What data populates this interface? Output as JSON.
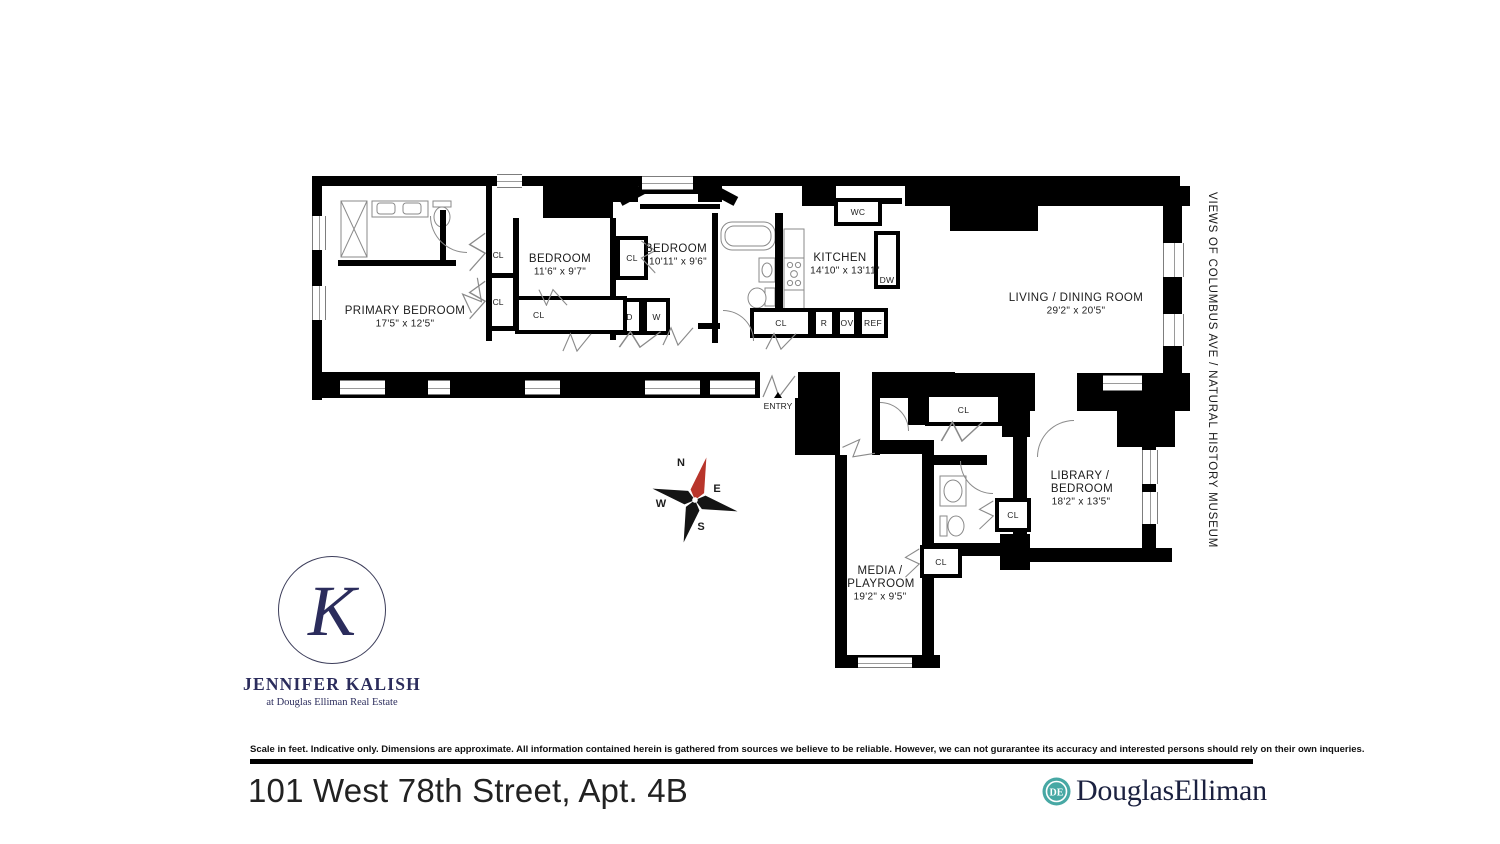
{
  "page": {
    "side_note": "VIEWS OF COLUMBUS AVE / NATURAL HISTORY MUSEUM",
    "address_title": "101 West 78th Street, Apt. 4B",
    "disclaimer": "Scale in feet. Indicative only. Dimensions are approximate. All information contained herein is gathered from sources we believe to be reliable. However, we can not gurarantee its accuracy and interested persons should rely on their own inqueries."
  },
  "agent": {
    "monogram": "K",
    "name": "JENNIFER KALISH",
    "tagline": "at Douglas Elliman Real Estate",
    "brand_color": "#2b2c5c"
  },
  "brokerage": {
    "wordmark": "DouglasElliman",
    "monogram": "DE",
    "icon_color": "#47a8a4",
    "text_color": "#1b2140"
  },
  "compass": {
    "north": "N",
    "south": "S",
    "east": "E",
    "west": "W",
    "north_color": "#b8352b",
    "arm_color": "#141414"
  },
  "floorplan": {
    "entry_label": "ENTRY",
    "rooms": {
      "primary_bedroom": {
        "name": "PRIMARY BEDROOM",
        "dims": "17'5\" x 12'5\""
      },
      "bedroom_1": {
        "name": "BEDROOM",
        "dims": "11'6\" x 9'7\""
      },
      "bedroom_2": {
        "name": "BEDROOM",
        "dims": "10'11\" x 9'6\""
      },
      "kitchen": {
        "name": "KITCHEN",
        "dims": "14'10\" x 13'11\""
      },
      "living_dining": {
        "name": "LIVING / DINING ROOM",
        "dims": "29'2\" x 20'5\""
      },
      "library_bedroom": {
        "name_line1": "LIBRARY /",
        "name_line2": "BEDROOM",
        "dims": "18'2\" x 13'5\""
      },
      "media_playroom": {
        "name_line1": "MEDIA /",
        "name_line2": "PLAYROOM",
        "dims": "19'2\" x 9'5\""
      }
    },
    "labels": {
      "closet": "CL",
      "water_closet": "WC",
      "dishwasher": "DW",
      "dryer": "D",
      "washer": "W",
      "range": "R",
      "oven": "OV",
      "refrigerator": "REF"
    }
  }
}
